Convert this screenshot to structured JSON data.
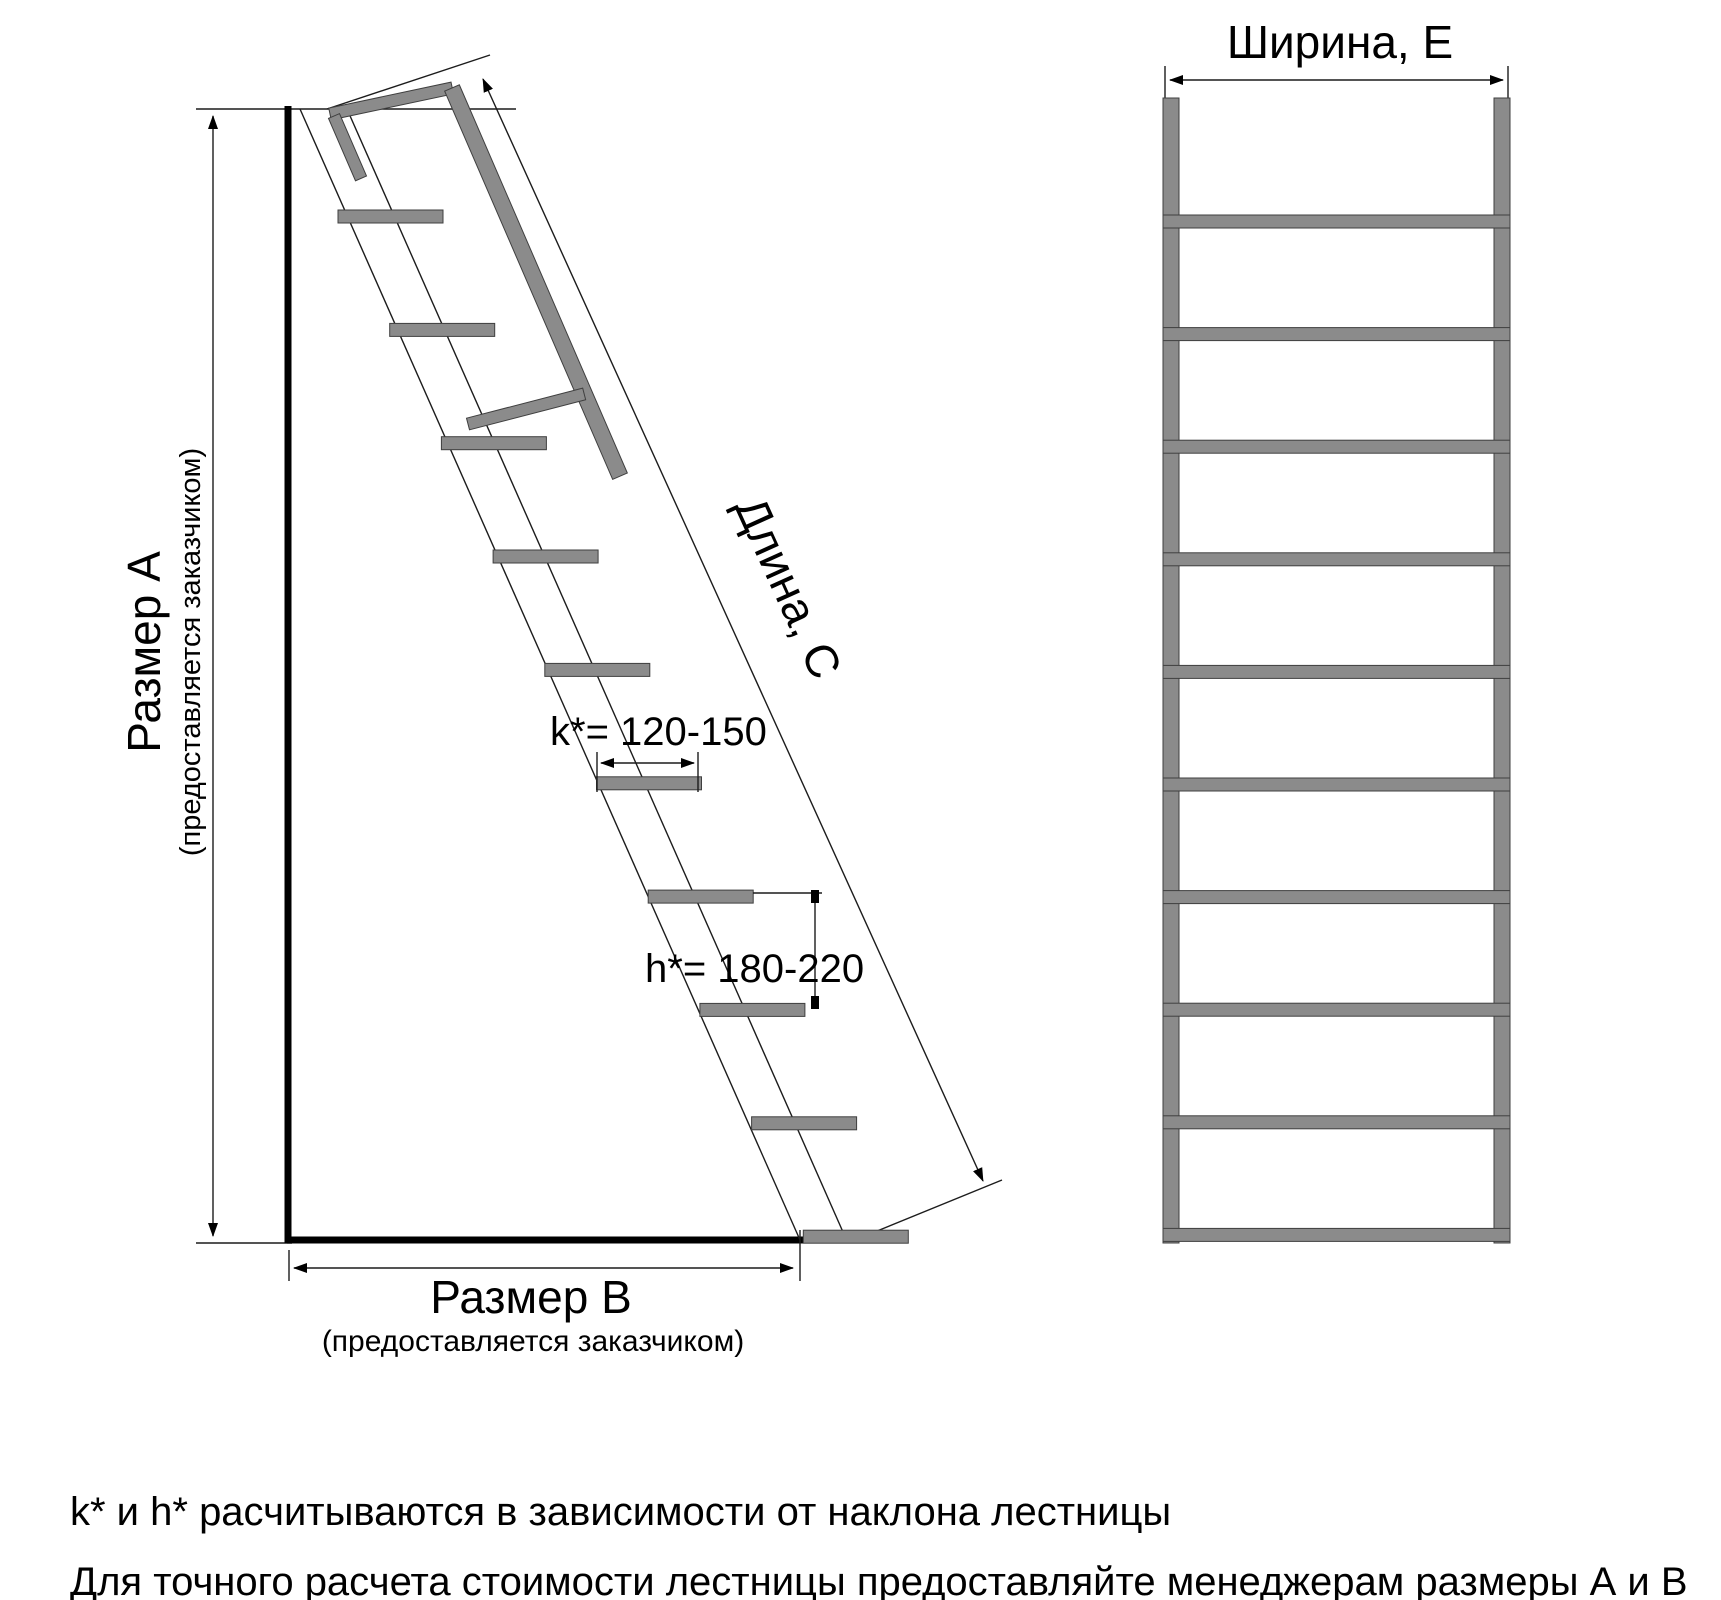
{
  "colors": {
    "background": "#ffffff",
    "line": "#1c1c1c",
    "steel_gray": "#8b8b8b",
    "text": "#000000"
  },
  "left_diagram": {
    "size_a_label": "Размер А",
    "size_a_note": "(предоставляется заказчиком)",
    "size_b_label": "Размер В",
    "size_b_note": "(предоставляется заказчиком)",
    "length_label": "Длина, С",
    "k_annotation": "k*= 120-150",
    "k_value": "120-150",
    "h_annotation": "h*= 180-220",
    "h_value": "180-220",
    "steps_count": 10
  },
  "right_diagram": {
    "width_label": "Ширина, Е",
    "rungs_count": 10
  },
  "notes": {
    "line1": "k* и h* расчитываются в зависимости от наклона лестницы",
    "line2": "Для точного расчета стоимости лестницы предоставляйте менеджерам размеры А и В"
  }
}
